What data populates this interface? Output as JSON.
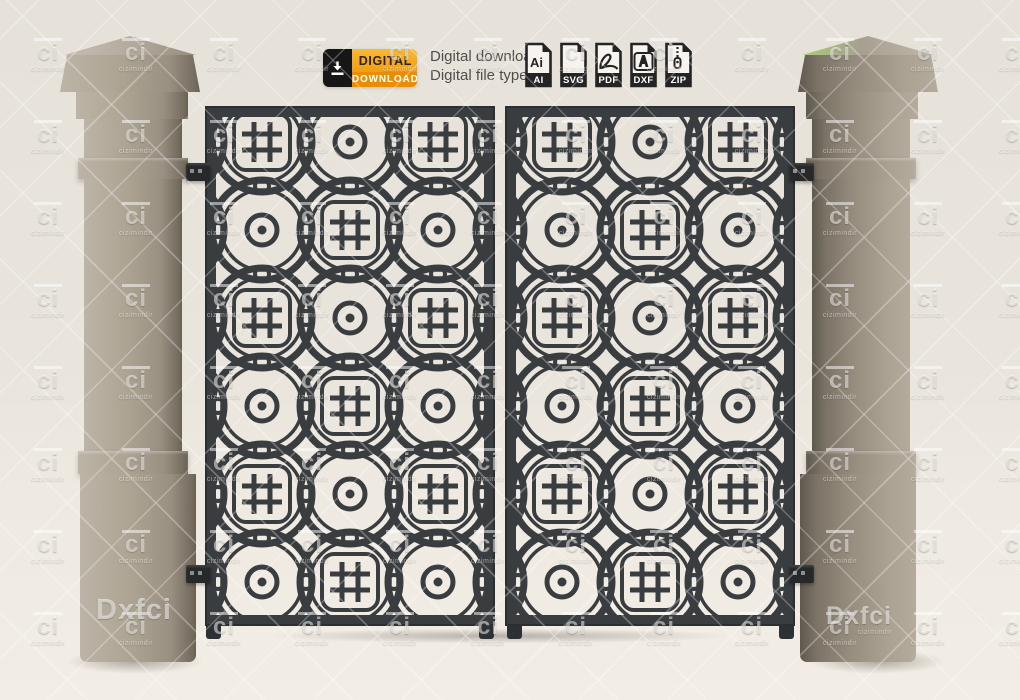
{
  "badge": {
    "icon": "download-icon",
    "line1": "DIGITAL",
    "line2": "DOWNLOAD"
  },
  "promo": {
    "line1": "Digital download",
    "line2": "Digital file type(s):"
  },
  "file_types": [
    {
      "icon": "ai-file-icon",
      "glyph_text": "Ai",
      "label": "AI"
    },
    {
      "icon": "svg-file-icon",
      "label": "SVG"
    },
    {
      "icon": "pdf-file-icon",
      "label": "PDF"
    },
    {
      "icon": "dxf-file-icon",
      "label": "DXF"
    },
    {
      "icon": "zip-file-icon",
      "label": "ZIP"
    }
  ],
  "watermark": {
    "logo": "ci",
    "name": "cizimindir",
    "corner_left": "Dxfci",
    "corner_right": "Dxfci",
    "corner_sub": "cizimindir",
    "grid": {
      "start_x": 20,
      "start_y": 38,
      "step_x": 88,
      "step_y": 82
    }
  },
  "colors": {
    "accent_orange": "#F49D14",
    "accent_orange_dark": "#E88E06",
    "gate_metal": "#3A3D40",
    "pillar_stone": "#A89F91",
    "background_cream": "#E9E4DC",
    "icon_ink": "#242424"
  }
}
